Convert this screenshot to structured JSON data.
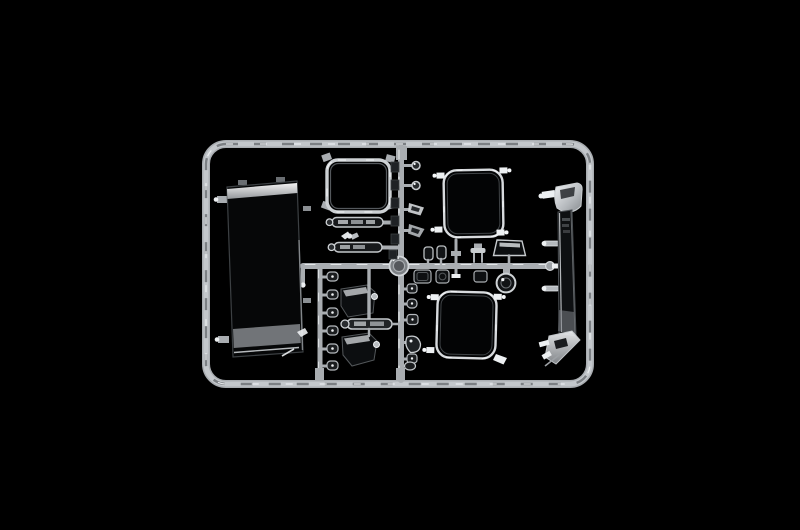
{
  "scene": {
    "description": "studio photograph on black background of a clear transparent plastic model-kit sprue (runner) holding window and mirror parts for a truck model",
    "colors": {
      "bg": "#000000",
      "sprue": "#a9adb1",
      "sprue_hi": "#edf0f2",
      "sprue_sh": "#595d61",
      "glass_edge": "#d6dadd",
      "glass_dark": "#060708"
    }
  },
  "sprue": {
    "frame": "rounded rectangular runner frame",
    "parts": [
      {
        "name": "windscreen",
        "area": "left",
        "appearance": "large dark glossy pane with bright top highlight and grey lower band"
      },
      {
        "name": "rear-window-frame",
        "area": "top-middle",
        "appearance": "rounded rectangular clear frame"
      },
      {
        "name": "visor-strip-upper",
        "area": "top-middle",
        "appearance": "long clear strip"
      },
      {
        "name": "visor-strip-lower",
        "area": "top-middle",
        "appearance": "long clear strip"
      },
      {
        "name": "wing-clip",
        "area": "top-middle",
        "appearance": "small winged clear clip"
      },
      {
        "name": "side-window-upper",
        "area": "right",
        "appearance": "rounded square pane, outline only visible"
      },
      {
        "name": "side-window-lower",
        "area": "right",
        "appearance": "rounded square pane, outline only visible"
      },
      {
        "name": "corner-deflector",
        "area": "far-right",
        "appearance": "tall curved strip, bright cap on top, angled foot at bottom"
      },
      {
        "name": "mirror-housing-upper",
        "area": "bottom-middle",
        "appearance": "dark angular mirror shell"
      },
      {
        "name": "mirror-housing-lower",
        "area": "bottom-middle",
        "appearance": "dark angular mirror shell"
      },
      {
        "name": "grab-handle-bar",
        "area": "bottom-middle",
        "appearance": "clear cylindrical bar"
      },
      {
        "name": "small-lens-column-left",
        "count": 6
      },
      {
        "name": "small-lens-column-right",
        "count": 6
      },
      {
        "name": "lamp-lens-strip",
        "count": 3,
        "area": "center, below runner"
      },
      {
        "name": "mirror-trapezoid",
        "area": "center-right"
      },
      {
        "name": "mirror-round",
        "area": "center-right"
      },
      {
        "name": "runner-medallion",
        "area": "center",
        "appearance": "round moulded boss at runner crossing"
      }
    ]
  }
}
